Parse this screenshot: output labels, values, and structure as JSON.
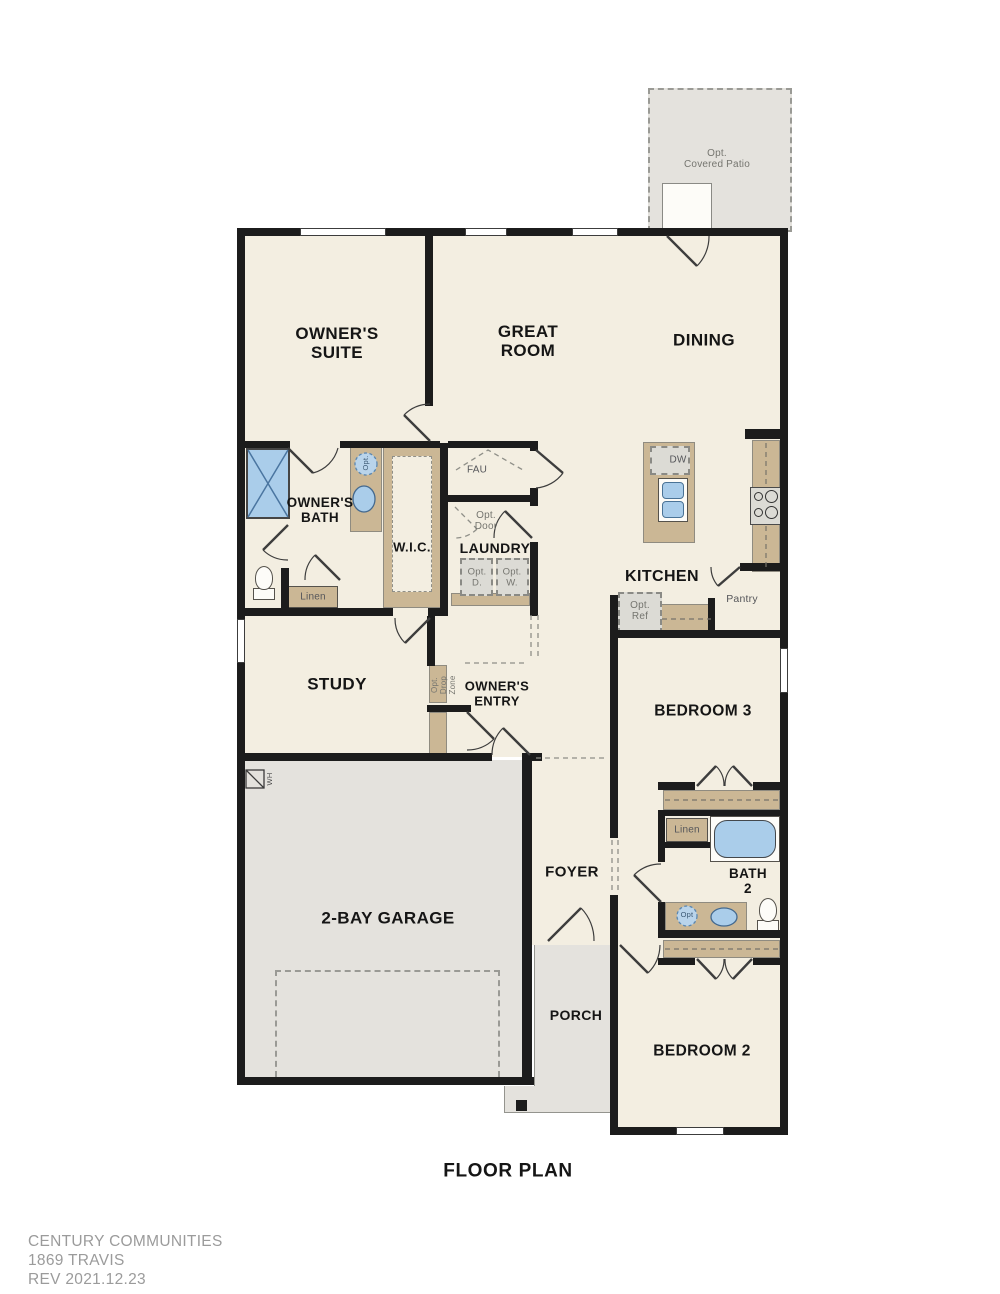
{
  "plan": {
    "title": "FLOOR PLAN",
    "brand": {
      "company": "CENTURY COMMUNITIES",
      "model": "1869 TRAVIS",
      "revision": "REV  2021.12.23"
    },
    "rooms": {
      "owners_suite": "OWNER'S\nSUITE",
      "great_room": "GREAT\nROOM",
      "dining": "DINING",
      "owners_bath": "OWNER'S\nBATH",
      "wic": "W.I.C.",
      "laundry": "LAUNDRY",
      "kitchen": "KITCHEN",
      "study": "STUDY",
      "owners_entry": "OWNER'S\nENTRY",
      "bedroom3": "BEDROOM 3",
      "bath2": "BATH\n2",
      "garage": "2-BAY GARAGE",
      "foyer": "FOYER",
      "porch": "PORCH",
      "bedroom2": "BEDROOM 2",
      "covered_patio": "Opt.\nCovered Patio"
    },
    "features": {
      "fau": "FAU",
      "opt_door": "Opt.\nDoor",
      "opt_dryer": "Opt.\nD.",
      "opt_washer": "Opt.\nW.",
      "dishwasher": "DW",
      "pantry": "Pantry",
      "opt_ref": "Opt.\nRef",
      "opt_drop_zone": "Opt.\nDrop\nZone",
      "owners_linen": "Linen",
      "bath2_linen": "Linen",
      "water_heater": "WH",
      "opt_sink_owners": "Opt.",
      "opt_sink_bath2": "Opt"
    },
    "colors": {
      "interior_floor": "#f3eee1",
      "outdoor_floor": "#e4e2dd",
      "wall": "#1c1c1c",
      "cabinetry": "#cbb795",
      "fixture_blue": "#aacdea",
      "appliance_gray": "#dcdbd5"
    }
  }
}
